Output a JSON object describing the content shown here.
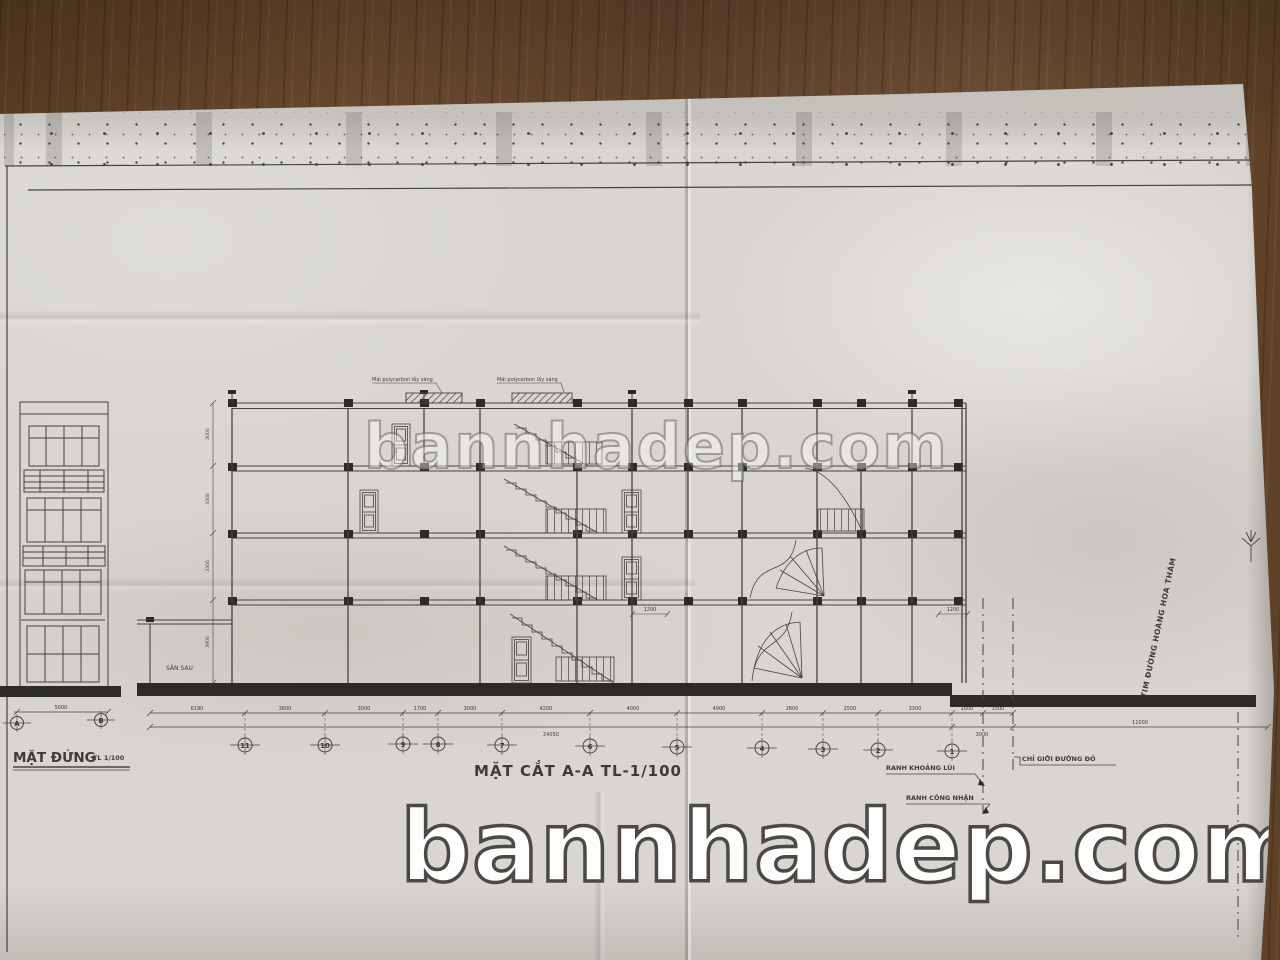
{
  "watermarks": {
    "middle": "bannhadep.com",
    "bottom": "bannhadep.com"
  },
  "elevation": {
    "title": "MẶT ĐỨNG",
    "scale": "TL 1/100",
    "width_dim": "5000",
    "grid_bubbles": [
      "A",
      "B"
    ]
  },
  "section": {
    "title": "MẶT CẮT A-A TL-1/100",
    "skylight_label": "Mái polycarbon lấy sáng",
    "yard_label": "SÂN SAU",
    "inner_dims": [
      "1200",
      "1200"
    ],
    "story_dims": [
      "3900",
      "3300",
      "3300",
      "3000"
    ],
    "grid_bubbles": [
      "11",
      "10",
      "9",
      "8",
      "7",
      "6",
      "5",
      "4",
      "3",
      "2",
      "1"
    ],
    "dims": [
      "6190",
      "3600",
      "3000",
      "1700",
      "3000",
      "4200",
      "4000",
      "4900",
      "2800",
      "2500",
      "3300",
      "1600",
      "1500"
    ],
    "totals": [
      "24050",
      "3000",
      "11000"
    ]
  },
  "annotations": {
    "setback": "RANH KHOẢNG LÙI",
    "boundary": "RANH CÔNG NHẬN",
    "red_line": "CHỈ GIỚI ĐƯỜNG ĐỎ",
    "road_axis": "TIM ĐƯỜNG HOÀNG HOA THÁM"
  },
  "colors": {
    "paper": "#d9d6d1",
    "wood": "#6a4a2e",
    "ink": "#3d3b38",
    "watermark": "#ffffff"
  }
}
